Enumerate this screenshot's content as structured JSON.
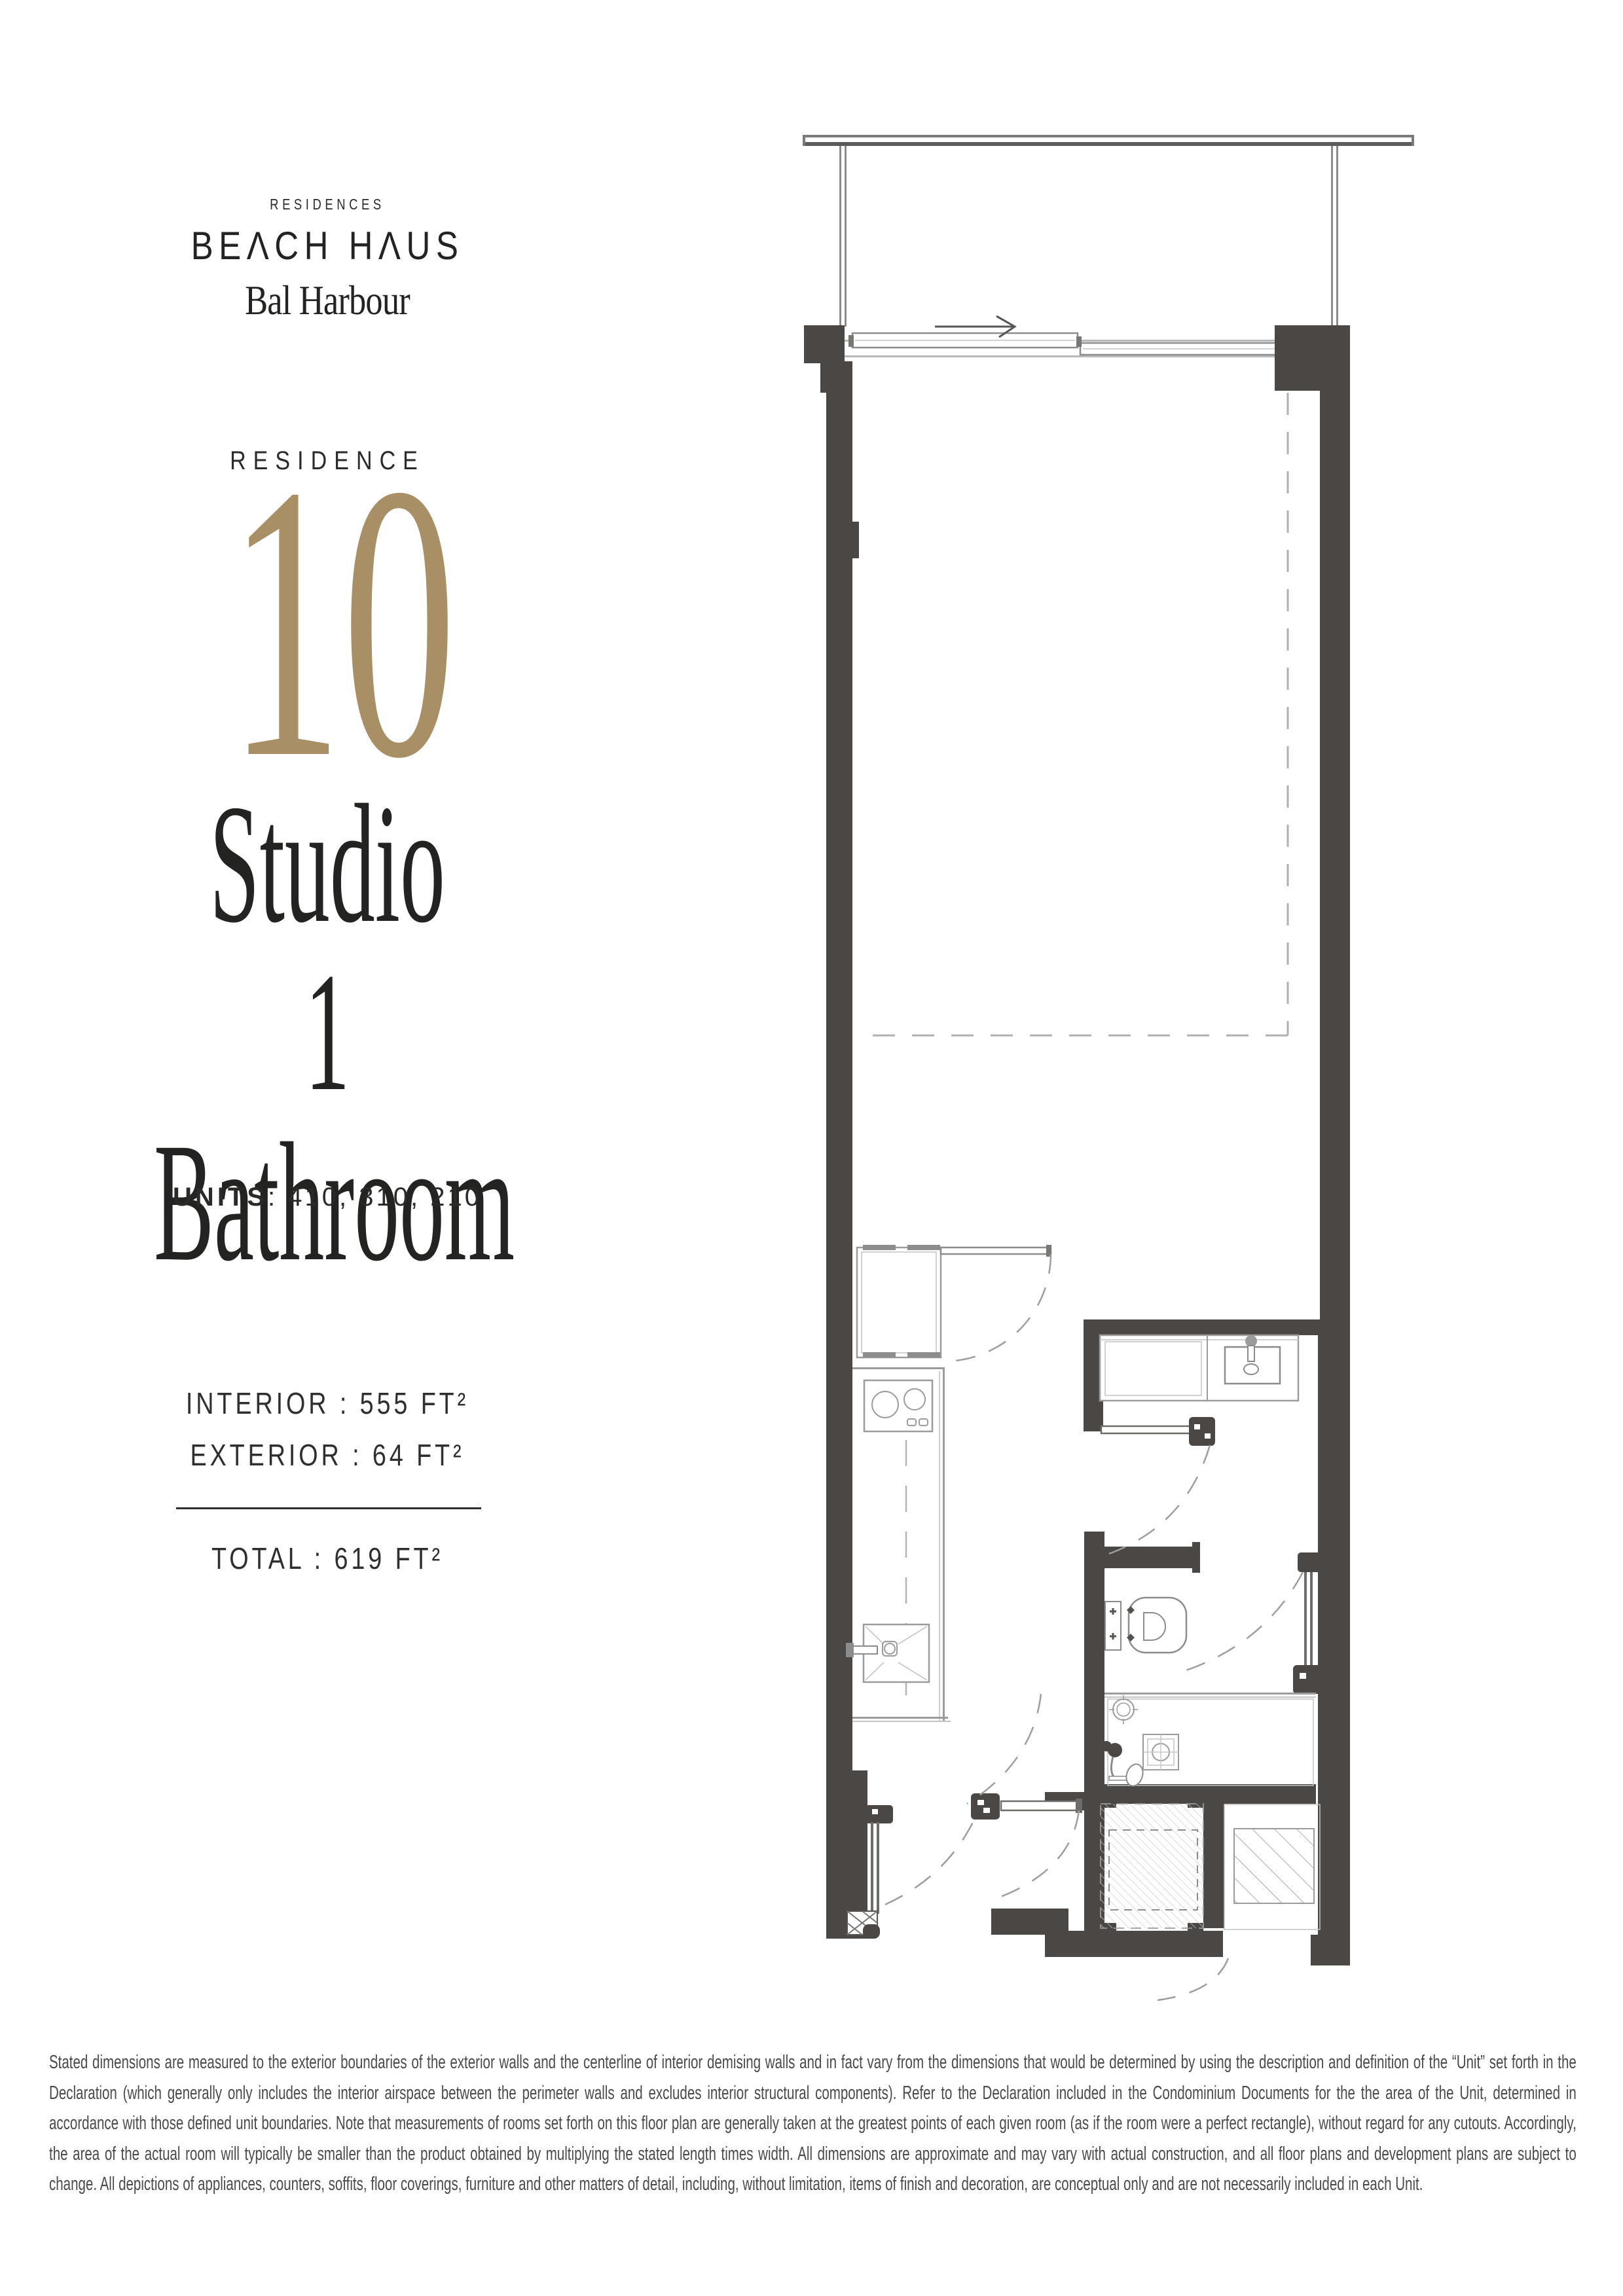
{
  "logo": {
    "residences": "RESIDENCES",
    "beach_haus": "BEΛCH HΛUS",
    "bal_harbour": "Bal Harbour"
  },
  "residence": {
    "label": "RESIDENCE",
    "number": "10",
    "type_line1": "Studio",
    "type_line2": "1 Bathroom"
  },
  "units": {
    "label": "UNITS",
    "rest": ":  410,  310,  210"
  },
  "areas": {
    "interior": "INTERIOR : 555 FT²",
    "exterior": "EXTERIOR : 64 FT²",
    "total": "TOTAL : 619 FT²"
  },
  "disclaimer": "Stated dimensions are measured to the exterior boundaries of the exterior walls and the centerline of interior demising walls and in fact vary from the dimensions that would be determined by using the description and definition of the “Unit” set forth in the Declaration (which generally only includes the interior airspace between the perimeter walls and excludes interior structural components).  Refer to the Declaration included in the Condominium Documents for the the area of the Unit, determined in accordance with those defined unit boundaries.  Note that measurements of rooms set forth on this floor plan are generally taken at the greatest points of each given room (as if the room were a perfect rectangle), without regard for any cutouts.  Accordingly, the area of the actual room will typically be smaller than the product obtained by multiplying the stated length times width.  All dimensions are approximate and may vary with actual construction, and all floor plans and development plans are subject to change.  All depictions of appliances, counters, soffits, floor coverings, furniture and other matters of detail, including, without limitation, items of finish and decoration, are conceptual only and are not necessarily included in each Unit.",
  "colors": {
    "accent_gold": "#a98f66",
    "wall": "#4b4744",
    "plan_line": "#9b9b9b",
    "text": "#1d1d1b"
  }
}
